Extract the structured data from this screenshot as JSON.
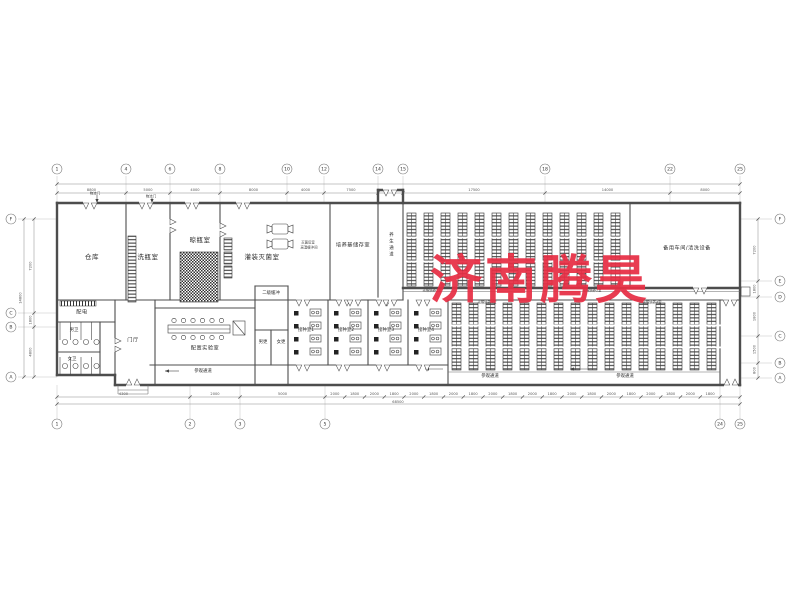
{
  "watermark": {
    "text": "济南腾昊",
    "color": "#e72e44"
  },
  "rooms": {
    "warehouse": "仓库",
    "bottle_washing": "洗瓶室",
    "bottle_airing": "晾瓶室",
    "filling_sterilizing": "灌装灭菌室",
    "medium_storage": "培养基储存室",
    "curing_corridor": "养生通道",
    "spare_workshop": "备用车间/清洗设备",
    "power_room": "配电",
    "mens_toilet": "男卫",
    "womens_toilet": "女卫",
    "entrance_hall": "门厅",
    "prep_lab": "配置实验室",
    "secondary_buffer": "二级缓冲",
    "mens_changing": "男更",
    "womens_changing": "女更",
    "inoculation_rooms": [
      "接种室1",
      "接种室2",
      "接种室3",
      "接种室4"
    ],
    "light_culture_rooms": [
      "光照培养1室",
      "光照培养2室",
      "光照培养3室",
      "光照培养4室"
    ],
    "visitor_corridor": "参观通道"
  },
  "annotations": {
    "logistics_door": "物流门",
    "post_sterilize_room": "灭菌后室",
    "high_temp_buffer": "高温缓冲间"
  },
  "grid": {
    "top_labels": [
      "1",
      "4",
      "6",
      "8",
      "10",
      "12",
      "14",
      "15",
      "18",
      "22",
      "25"
    ],
    "bottom_labels": [
      "1",
      "2",
      "3",
      "5",
      "24",
      "25"
    ],
    "left_labels": [
      "F",
      "C",
      "B",
      "A"
    ],
    "right_labels": [
      "F",
      "E",
      "D",
      "C",
      "B",
      "A"
    ]
  },
  "dimensions": {
    "top": [
      "8800",
      "5000",
      "4000",
      "8000",
      "4000",
      "7500",
      "1800",
      "17500",
      "14000",
      "8000"
    ],
    "bottom_left": [
      "4300",
      "2000",
      "5000"
    ],
    "bottom_series": [
      "2000",
      "1800"
    ],
    "bottom_total": "68500",
    "left": [
      "7200",
      "1800",
      "4800"
    ],
    "left_total": "14800",
    "right": [
      "7200",
      "1800",
      "1800",
      "1500",
      "800"
    ]
  }
}
